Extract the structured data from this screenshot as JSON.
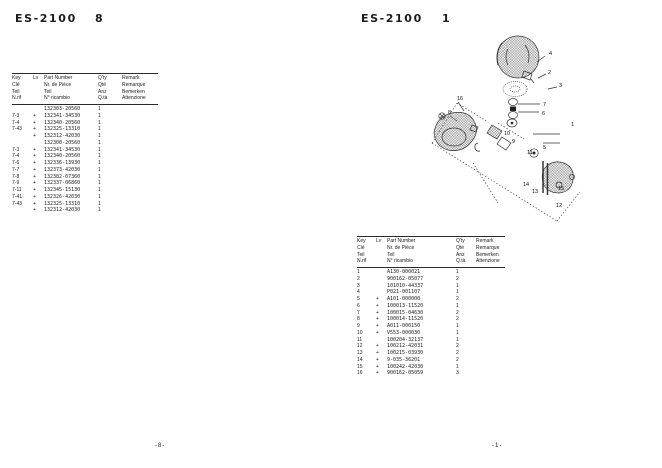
{
  "pages": {
    "left": {
      "title": "ES-2100",
      "section": "8",
      "footer": "-8-",
      "table": {
        "headers": {
          "key": [
            "Key",
            "Clé",
            "Teil",
            "N.rif"
          ],
          "lv": "Lv",
          "part": [
            "Part Number",
            "Nr. de Pièce",
            "Teil",
            "N° ricambio"
          ],
          "qty": [
            "Q'ty",
            "Qté",
            "Anz",
            "Q.tà"
          ],
          "remark": [
            "Remark",
            "Remarque",
            "Bemerken",
            "Attenzione"
          ]
        },
        "rows": [
          {
            "key": "",
            "lv": "",
            "part": "132303-20560",
            "qty": "1",
            "remark": ""
          },
          {
            "key": "7-3",
            "lv": "+",
            "part": "132341-34530",
            "qty": "1",
            "remark": ""
          },
          {
            "key": "7-4",
            "lv": "+",
            "part": "132340-20560",
            "qty": "1",
            "remark": ""
          },
          {
            "key": "7-43",
            "lv": "+",
            "part": "132325-13310",
            "qty": "1",
            "remark": ""
          },
          {
            "key": "",
            "lv": "+",
            "part": "132312-42030",
            "qty": "1",
            "remark": ""
          },
          {
            "key": "",
            "lv": "",
            "part": "132300-20560",
            "qty": "1",
            "remark": ""
          },
          {
            "key": "7-3",
            "lv": "+",
            "part": "132341-34530",
            "qty": "1",
            "remark": ""
          },
          {
            "key": "7-4",
            "lv": "+",
            "part": "132340-20560",
            "qty": "1",
            "remark": ""
          },
          {
            "key": "7-6",
            "lv": "+",
            "part": "132336-13930",
            "qty": "1",
            "remark": ""
          },
          {
            "key": "7-7",
            "lv": "+",
            "part": "132373-42030",
            "qty": "1",
            "remark": ""
          },
          {
            "key": "7-8",
            "lv": "+",
            "part": "132382-07360",
            "qty": "1",
            "remark": ""
          },
          {
            "key": "7-9",
            "lv": "+",
            "part": "132337-06860",
            "qty": "1",
            "remark": ""
          },
          {
            "key": "7-11",
            "lv": "+",
            "part": "132345-15130",
            "qty": "1",
            "remark": ""
          },
          {
            "key": "7-41",
            "lv": "+",
            "part": "132326-42030",
            "qty": "1",
            "remark": ""
          },
          {
            "key": "7-43",
            "lv": "+",
            "part": "132325-13310",
            "qty": "1",
            "remark": ""
          },
          {
            "key": "",
            "lv": "+",
            "part": "132312-42030",
            "qty": "1",
            "remark": ""
          }
        ]
      }
    },
    "right": {
      "title": "ES-2100",
      "section": "1",
      "footer": "-1-",
      "diagram": {
        "callouts": [
          {
            "n": "1",
            "x": 159,
            "y": 101
          },
          {
            "n": "2",
            "x": 136,
            "y": 49
          },
          {
            "n": "3",
            "x": 147,
            "y": 62
          },
          {
            "n": "4",
            "x": 137,
            "y": 30
          },
          {
            "n": "5",
            "x": 131,
            "y": 124
          },
          {
            "n": "6",
            "x": 130,
            "y": 90
          },
          {
            "n": "7",
            "x": 131,
            "y": 81
          },
          {
            "n": "8",
            "x": 36,
            "y": 89
          },
          {
            "n": "9",
            "x": 100,
            "y": 118
          },
          {
            "n": "10",
            "x": 92,
            "y": 110
          },
          {
            "n": "11",
            "x": 115,
            "y": 129
          },
          {
            "n": "12",
            "x": 144,
            "y": 182
          },
          {
            "n": "13",
            "x": 120,
            "y": 168
          },
          {
            "n": "14",
            "x": 111,
            "y": 161
          },
          {
            "n": "15",
            "x": 146,
            "y": 165
          },
          {
            "n": "16",
            "x": 45,
            "y": 75
          }
        ]
      },
      "table": {
        "headers": {
          "key": [
            "Key",
            "Clé",
            "Teil",
            "N.rif"
          ],
          "lv": "Lv",
          "part": [
            "Part Number",
            "Nr. de Pièce",
            "Teil",
            "N° ricambio"
          ],
          "qty": [
            "Q'ty",
            "Qté",
            "Anz",
            "Q.tà"
          ],
          "remark": [
            "Remark",
            "Remarque",
            "Bemerken",
            "Attenzione"
          ]
        },
        "rows": [
          {
            "key": "1",
            "lv": "",
            "part": "A130-000021",
            "qty": "1",
            "remark": ""
          },
          {
            "key": "2",
            "lv": "",
            "part": "900162-05077",
            "qty": "2",
            "remark": ""
          },
          {
            "key": "3",
            "lv": "",
            "part": "101010-44337",
            "qty": "1",
            "remark": ""
          },
          {
            "key": "4",
            "lv": "",
            "part": "P021-001107",
            "qty": "1",
            "remark": ""
          },
          {
            "key": "5",
            "lv": "+",
            "part": "A101-000000",
            "qty": "2",
            "remark": ""
          },
          {
            "key": "6",
            "lv": "+",
            "part": "100013-11520",
            "qty": "1",
            "remark": ""
          },
          {
            "key": "7",
            "lv": "+",
            "part": "100015-04630",
            "qty": "2",
            "remark": ""
          },
          {
            "key": "8",
            "lv": "+",
            "part": "100014-11520",
            "qty": "2",
            "remark": ""
          },
          {
            "key": "9",
            "lv": "+",
            "part": "A011-000150",
            "qty": "1",
            "remark": ""
          },
          {
            "key": "10",
            "lv": "+",
            "part": "V553-000030",
            "qty": "1",
            "remark": ""
          },
          {
            "key": "11",
            "lv": "",
            "part": "100204-32137",
            "qty": "1",
            "remark": ""
          },
          {
            "key": "12",
            "lv": "+",
            "part": "100212-42031",
            "qty": "2",
            "remark": ""
          },
          {
            "key": "13",
            "lv": "+",
            "part": "100215-03930",
            "qty": "2",
            "remark": ""
          },
          {
            "key": "14",
            "lv": "+",
            "part": "9-035-36201",
            "qty": "2",
            "remark": ""
          },
          {
            "key": "15",
            "lv": "+",
            "part": "100242-42030",
            "qty": "1",
            "remark": ""
          },
          {
            "key": "16",
            "lv": "+",
            "part": "900162-05059",
            "qty": "3",
            "remark": ""
          }
        ]
      }
    }
  }
}
